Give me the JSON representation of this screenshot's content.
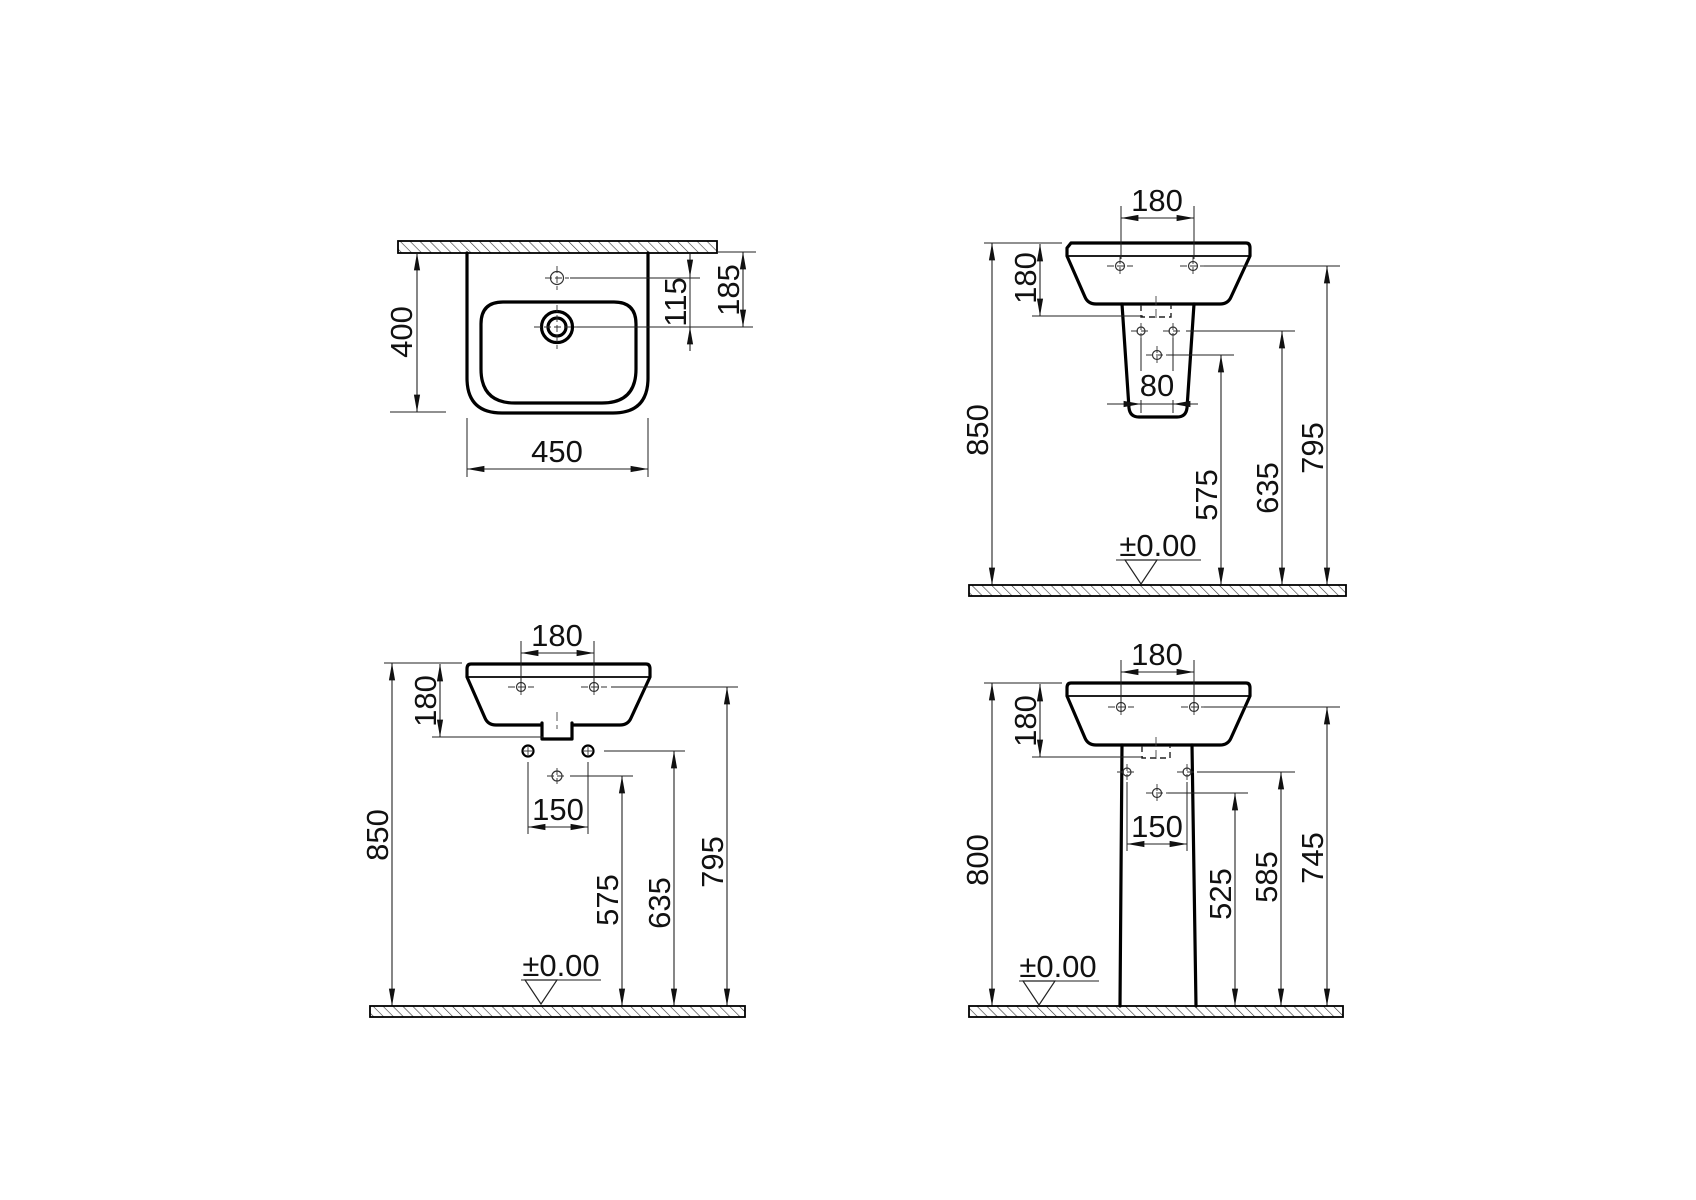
{
  "drawing": {
    "background": "#ffffff",
    "ink": "#000000",
    "views": {
      "plan": {
        "width": "450",
        "depth": "400",
        "tap_to_drain": "115",
        "wall_to_drain": "185"
      },
      "half_pedestal": {
        "fixing_spacing": "180",
        "basin_height": "180",
        "rim_height": "850",
        "trap_spacing": "80",
        "drain_height": "575",
        "bracket_height": "635",
        "fixing_height": "795",
        "datum": "±0.00"
      },
      "wall_hung": {
        "fixing_spacing": "180",
        "basin_height": "180",
        "rim_height": "850",
        "supply_spacing": "150",
        "drain_height": "575",
        "supply_height": "635",
        "fixing_height": "795",
        "datum": "±0.00"
      },
      "pedestal": {
        "fixing_spacing": "180",
        "basin_height": "180",
        "rim_height": "800",
        "supply_spacing": "150",
        "drain_height": "525",
        "supply_height": "585",
        "fixing_height": "745",
        "datum": "±0.00"
      }
    }
  }
}
